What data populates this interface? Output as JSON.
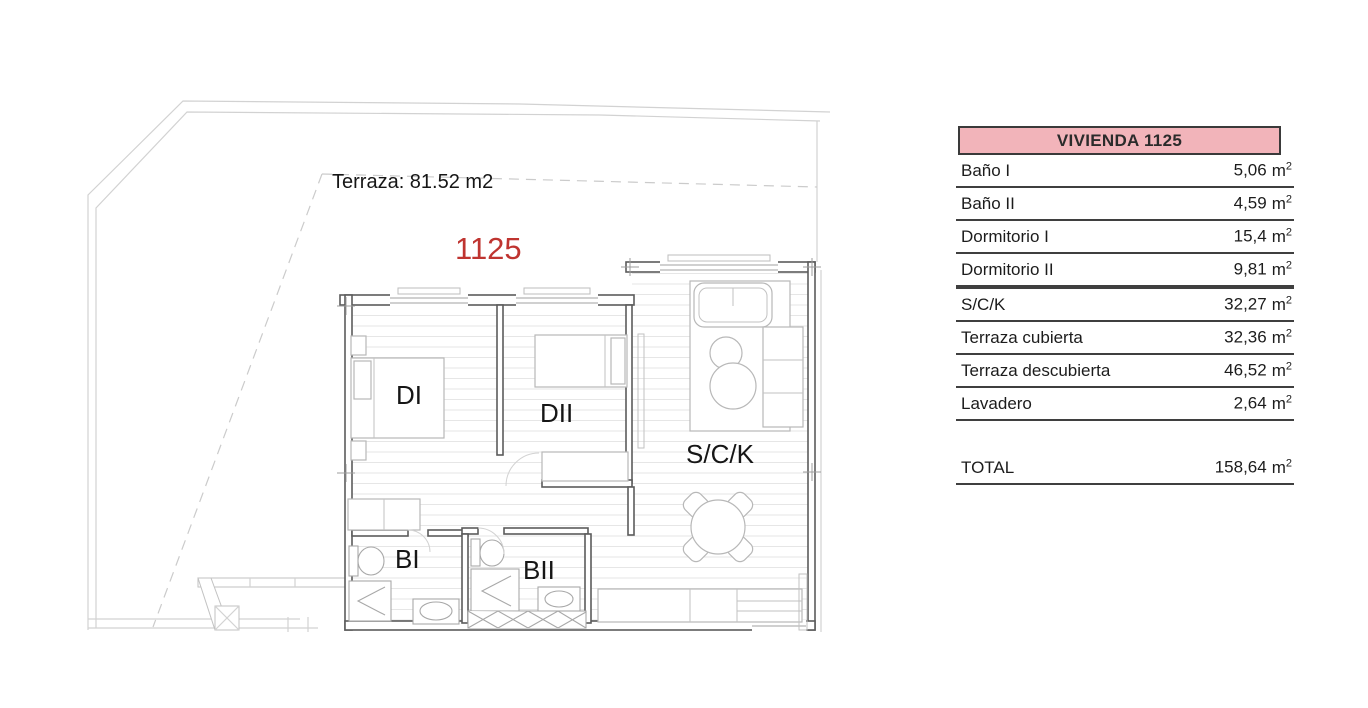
{
  "plan": {
    "terrace_label": "Terraza: 81.52 m2",
    "unit_number": "1125",
    "rooms": {
      "di": "DI",
      "dii": "DII",
      "sck": "S/C/K",
      "bi": "BI",
      "bii": "BII"
    }
  },
  "table": {
    "header": "VIVIENDA 1125",
    "unit_base": "m",
    "unit_exponent": "2",
    "rows": [
      {
        "label": "Baño I",
        "value": "5,06"
      },
      {
        "label": "Baño II",
        "value": "4,59"
      },
      {
        "label": "Dormitorio I",
        "value": "15,4"
      },
      {
        "label": "Dormitorio II",
        "value": "9,81"
      },
      {
        "label": "S/C/K",
        "value": "32,27"
      },
      {
        "label": "Terraza cubierta",
        "value": "32,36"
      },
      {
        "label": "Terraza descubierta",
        "value": "46,52"
      },
      {
        "label": "Lavadero",
        "value": "2,64"
      }
    ],
    "total": {
      "label": "TOTAL",
      "value": "158,64"
    }
  },
  "colors": {
    "header_pink": "#f2b4ba",
    "unit_number_red": "#bf3430",
    "wall_gray": "#5c5c5c"
  }
}
